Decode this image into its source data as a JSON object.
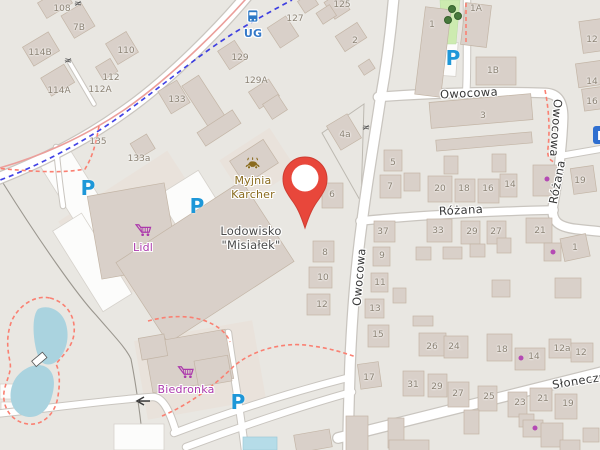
{
  "map": {
    "streets": [
      {
        "name": "Owocowa",
        "x": 469,
        "y": 93,
        "rot": -3
      },
      {
        "name": "Owocowa",
        "x": 556,
        "y": 128,
        "rot": 94
      },
      {
        "name": "Owocowa",
        "x": 359,
        "y": 277,
        "rot": -85
      },
      {
        "name": "Różana",
        "x": 461,
        "y": 210,
        "rot": -3
      },
      {
        "name": "Różana",
        "x": 557,
        "y": 182,
        "rot": -79
      },
      {
        "name": "Słoneczna",
        "x": 583,
        "y": 380,
        "rot": -9
      }
    ],
    "housenumbers": [
      {
        "t": "108",
        "x": 62,
        "y": 9
      },
      {
        "t": "7B",
        "x": 79,
        "y": 28
      },
      {
        "t": "114B",
        "x": 40,
        "y": 53
      },
      {
        "t": "110",
        "x": 126,
        "y": 51
      },
      {
        "t": "112",
        "x": 111,
        "y": 78
      },
      {
        "t": "112A",
        "x": 100,
        "y": 90
      },
      {
        "t": "114A",
        "x": 59,
        "y": 91
      },
      {
        "t": "133",
        "x": 177,
        "y": 100
      },
      {
        "t": "135",
        "x": 98,
        "y": 142
      },
      {
        "t": "133a",
        "x": 139,
        "y": 159
      },
      {
        "t": "125",
        "x": 342,
        "y": 5
      },
      {
        "t": "127",
        "x": 295,
        "y": 19
      },
      {
        "t": "129",
        "x": 240,
        "y": 58
      },
      {
        "t": "129A",
        "x": 256,
        "y": 81
      },
      {
        "t": "2",
        "x": 355,
        "y": 41
      },
      {
        "t": "4a",
        "x": 345,
        "y": 135
      },
      {
        "t": "1",
        "x": 432,
        "y": 25
      },
      {
        "t": "1A",
        "x": 476,
        "y": 9
      },
      {
        "t": "1B",
        "x": 493,
        "y": 71
      },
      {
        "t": "12",
        "x": 592,
        "y": 40
      },
      {
        "t": "14",
        "x": 592,
        "y": 82
      },
      {
        "t": "16",
        "x": 592,
        "y": 102
      },
      {
        "t": "3",
        "x": 483,
        "y": 116
      },
      {
        "t": "5",
        "x": 393,
        "y": 163
      },
      {
        "t": "7",
        "x": 390,
        "y": 187
      },
      {
        "t": "20",
        "x": 440,
        "y": 189
      },
      {
        "t": "18",
        "x": 464,
        "y": 189
      },
      {
        "t": "16",
        "x": 488,
        "y": 189
      },
      {
        "t": "14",
        "x": 510,
        "y": 185
      },
      {
        "t": "19",
        "x": 580,
        "y": 181
      },
      {
        "t": "6",
        "x": 332,
        "y": 195
      },
      {
        "t": "8",
        "x": 325,
        "y": 253
      },
      {
        "t": "10",
        "x": 323,
        "y": 278
      },
      {
        "t": "12",
        "x": 322,
        "y": 305
      },
      {
        "t": "37",
        "x": 383,
        "y": 232
      },
      {
        "t": "9",
        "x": 382,
        "y": 256
      },
      {
        "t": "11",
        "x": 380,
        "y": 283
      },
      {
        "t": "13",
        "x": 375,
        "y": 309
      },
      {
        "t": "15",
        "x": 378,
        "y": 335
      },
      {
        "t": "33",
        "x": 438,
        "y": 231
      },
      {
        "t": "29",
        "x": 472,
        "y": 232
      },
      {
        "t": "27",
        "x": 496,
        "y": 232
      },
      {
        "t": "21",
        "x": 540,
        "y": 231
      },
      {
        "t": "1",
        "x": 575,
        "y": 248
      },
      {
        "t": "26",
        "x": 432,
        "y": 347
      },
      {
        "t": "24",
        "x": 454,
        "y": 347
      },
      {
        "t": "18",
        "x": 502,
        "y": 350
      },
      {
        "t": "14",
        "x": 534,
        "y": 357
      },
      {
        "t": "12a",
        "x": 562,
        "y": 349
      },
      {
        "t": "12",
        "x": 581,
        "y": 353
      },
      {
        "t": "17",
        "x": 369,
        "y": 378
      },
      {
        "t": "31",
        "x": 413,
        "y": 385
      },
      {
        "t": "29",
        "x": 437,
        "y": 387
      },
      {
        "t": "27",
        "x": 458,
        "y": 394
      },
      {
        "t": "25",
        "x": 489,
        "y": 397
      },
      {
        "t": "23",
        "x": 520,
        "y": 403
      },
      {
        "t": "21",
        "x": 543,
        "y": 399
      },
      {
        "t": "19",
        "x": 568,
        "y": 404
      }
    ],
    "pois": {
      "lidl": {
        "label": "Lidl"
      },
      "biedronka": {
        "label": "Biedronka"
      },
      "carwash": {
        "line1": "Myjnia",
        "line2": "Karcher"
      },
      "icerink": {
        "line1": "Lodowisko",
        "line2": "\"Misiałek\""
      },
      "busstop": {
        "label": "UG"
      }
    },
    "parking_symbols": [
      {
        "x": 88,
        "y": 188
      },
      {
        "x": 197,
        "y": 206
      },
      {
        "x": 453,
        "y": 58
      },
      {
        "x": 238,
        "y": 402
      }
    ],
    "shop_dots": [
      {
        "x": 547,
        "y": 179
      },
      {
        "x": 553,
        "y": 252
      },
      {
        "x": 521,
        "y": 358
      },
      {
        "x": 535,
        "y": 428
      }
    ],
    "gates": [
      {
        "x": 78,
        "y": 4,
        "rot": 10
      },
      {
        "x": 68,
        "y": 61,
        "rot": 15
      },
      {
        "x": 366,
        "y": 128,
        "rot": 10
      }
    ],
    "trees": [
      {
        "x": 452,
        "y": 9
      },
      {
        "x": 458,
        "y": 16
      },
      {
        "x": 448,
        "y": 20
      }
    ],
    "colors": {
      "marker": "#e8473b",
      "shop": "#ac39ac",
      "parking": "#1e97d8",
      "transport": "#2d79c6",
      "carwash": "#8a6b1e",
      "water": "#aad3df",
      "grass": "#cdebb0",
      "footpath": "#fa8072",
      "cycleway": "#2021e0",
      "building": "#d9d0c9",
      "land": "#e9e7e2"
    }
  }
}
